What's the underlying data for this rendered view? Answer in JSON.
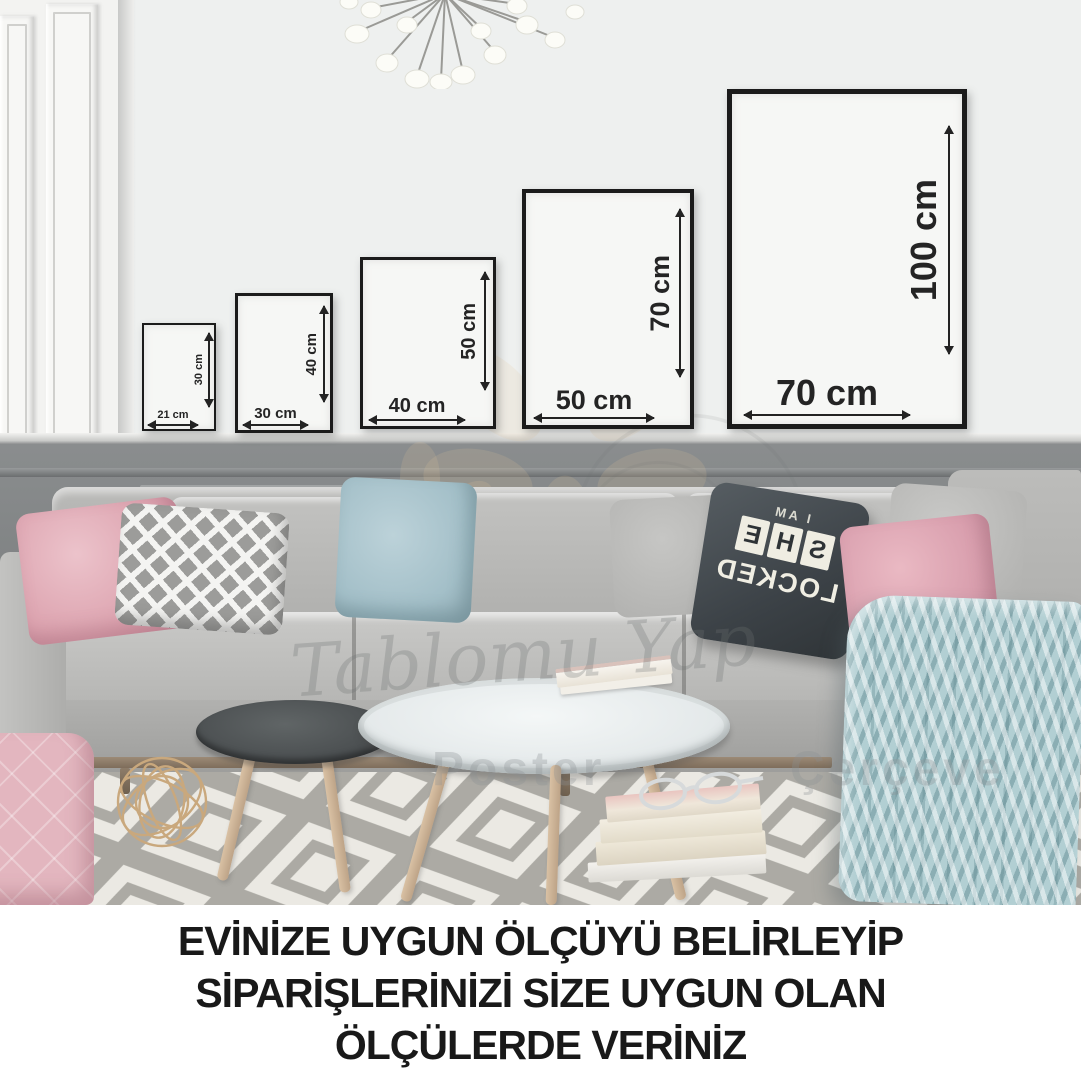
{
  "caption": {
    "line1": "EVİNİZE UYGUN ÖLÇÜYÜ BELİRLEYİP",
    "line2": "SİPARİŞLERİNİZİ SİZE UYGUN OLAN",
    "line3": "ÖLÇÜLERDE VERİNİZ"
  },
  "frames": [
    {
      "width_label": "21 cm",
      "height_label": "30 cm"
    },
    {
      "width_label": "30 cm",
      "height_label": "40 cm"
    },
    {
      "width_label": "40 cm",
      "height_label": "50 cm"
    },
    {
      "width_label": "50 cm",
      "height_label": "70 cm"
    },
    {
      "width_label": "70 cm",
      "height_label": "100 cm"
    }
  ],
  "watermark": {
    "script": "Tablomu Yap",
    "word1": "Poster",
    "word2": "Çerçeve"
  },
  "pillow_print": {
    "line1": "I AM",
    "line2": "SHE",
    "line3": "LOCKED"
  },
  "colors": {
    "frame_border": "#1b1b1b",
    "caption_text": "#191919",
    "wainscot_gray": "#7e8182",
    "sofa_gray": "#b5b5b3",
    "pink_pillow": "#dda4b0",
    "blue_pillow": "#a3bfc8",
    "blanket_blue": "#b2cfd3",
    "wall_white": "#eef0ef"
  }
}
